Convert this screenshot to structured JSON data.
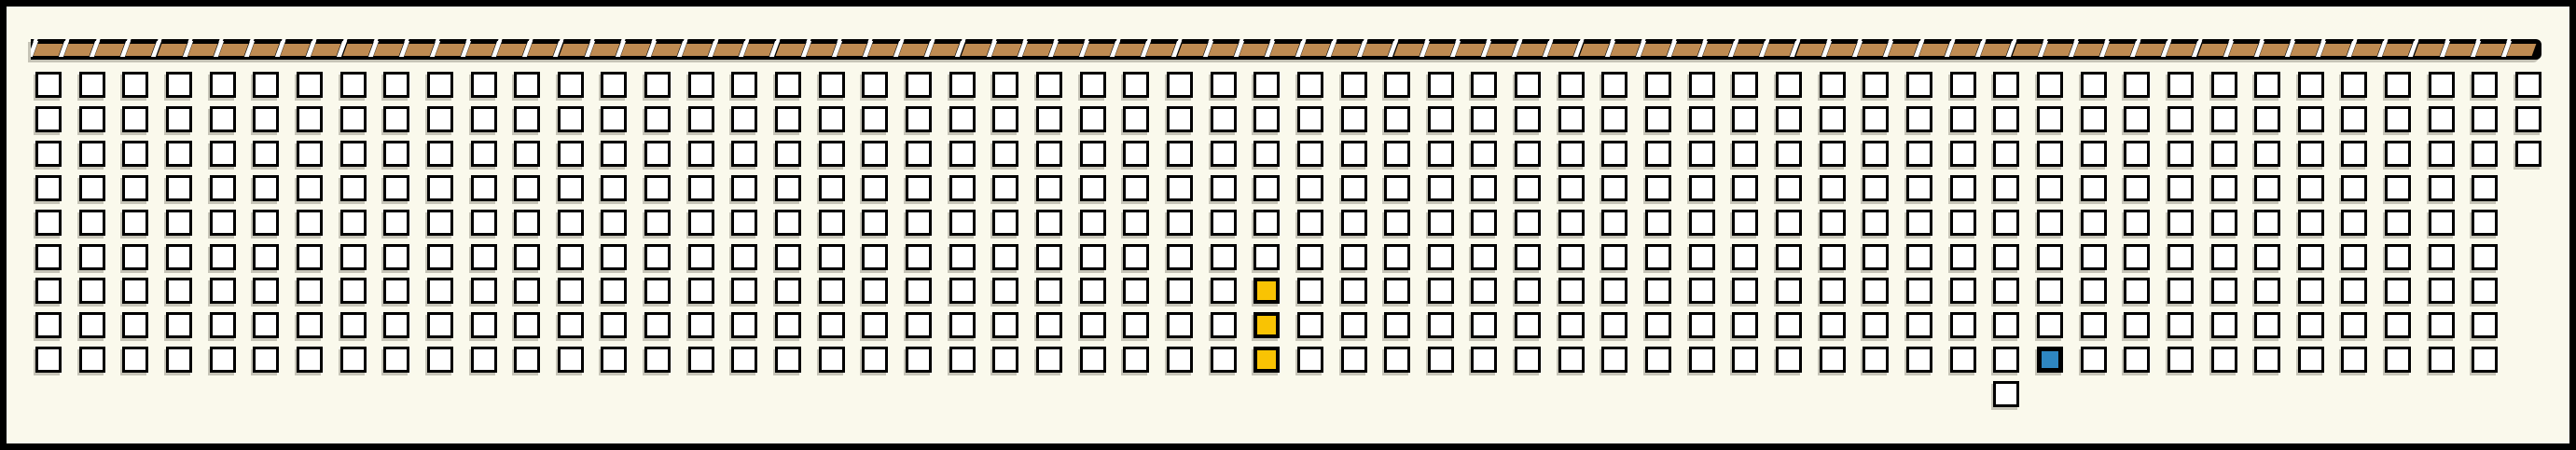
{
  "scene": {
    "background_color": "#FAF9EC",
    "outline_color": "#000000"
  },
  "stage_strip": {
    "segment_count": 81,
    "bar_color": "#000000",
    "plank_color": "#BF8B52",
    "gap_color": "#FFFFFF"
  },
  "seat_grid": {
    "rows": [
      {
        "row": 1,
        "seats": 58
      },
      {
        "row": 2,
        "seats": 58
      },
      {
        "row": 3,
        "seats": 58
      },
      {
        "row": 4,
        "seats": 57
      },
      {
        "row": 5,
        "seats": 57
      },
      {
        "row": 6,
        "seats": 57
      },
      {
        "row": 7,
        "seats": 57
      },
      {
        "row": 8,
        "seats": 57
      },
      {
        "row": 9,
        "seats": 57
      }
    ],
    "extra_seat": {
      "row": 10,
      "col": 46
    },
    "seat_colors": {
      "default": "#FFFFFF",
      "outline": "#000000",
      "yellow": "#F9C303",
      "blue": "#2E86C1"
    },
    "highlighted_seats": [
      {
        "row": 7,
        "col": 29,
        "state": "yellow"
      },
      {
        "row": 8,
        "col": 29,
        "state": "yellow"
      },
      {
        "row": 9,
        "col": 29,
        "state": "yellow"
      },
      {
        "row": 9,
        "col": 47,
        "state": "blue"
      }
    ]
  }
}
